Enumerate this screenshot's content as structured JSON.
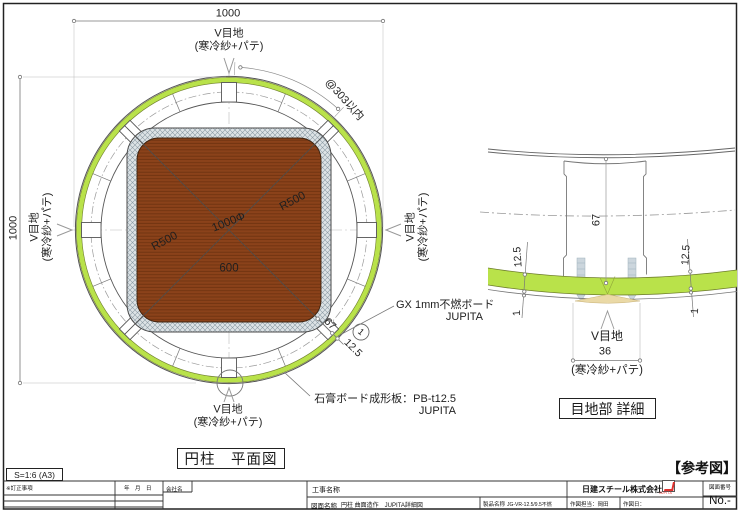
{
  "plan": {
    "title": "円柱　平面図",
    "dim_top": "1000",
    "dim_left": "1000",
    "vjoint": {
      "line1": "V目地",
      "line2": "(寒冷紗+パテ)"
    },
    "pitch": "@303以内",
    "diameter": "1000Φ",
    "radius1": "R500",
    "radius2": "R500",
    "core": "600",
    "dim_board_zone": "67",
    "dim_board_thk": "12.5",
    "balloon": "1",
    "gx_label": {
      "line1": "GX 1mm不燃ボード",
      "line2": "JUPITA"
    },
    "pb_label": {
      "line1": "石膏ボード成形板：PB-t12.5",
      "line2": "JUPITA"
    }
  },
  "detail": {
    "title": "目地部 詳細",
    "dim_depth": "67",
    "dim_thk_left": "12.5",
    "dim_thk_right": "12.5",
    "dim_gx_left": "1",
    "dim_gx_right": "1",
    "vjoint_label": "V目地",
    "vjoint_width": "36",
    "vjoint_note": "(寒冷紗+パテ)"
  },
  "sheet": {
    "scale": "S=1:6 (A3)",
    "reference_note": "【参考図】",
    "title_block": {
      "revision_header": "※訂正事項",
      "date_header": "年　月　日",
      "company_header": "会社名",
      "project_label": "工事名称",
      "drawing_label": "図面名称",
      "drawing_value": "円柱 曲面造作　JUPITA詳細図",
      "product_label": "製品名称",
      "product_value": "JG-VR-12.5/9.5不燃",
      "drafter_label": "作図担当：岡田",
      "drawn_date_label": "作図日：",
      "company_name": "日建スチール株式会社",
      "logo_text": "JUPITA",
      "number_header": "図面番号",
      "number_value": "No.-"
    }
  },
  "colors": {
    "board_green": "#b9e24a",
    "green_edge": "#6e7d2c",
    "wood_brown": "#8b421a",
    "hatch_gray": "#dde3e6",
    "screw_gray": "#ccd6dd",
    "putty_tan": "#ead9a6",
    "line": "#555555",
    "logo_red": "#e0312e"
  }
}
